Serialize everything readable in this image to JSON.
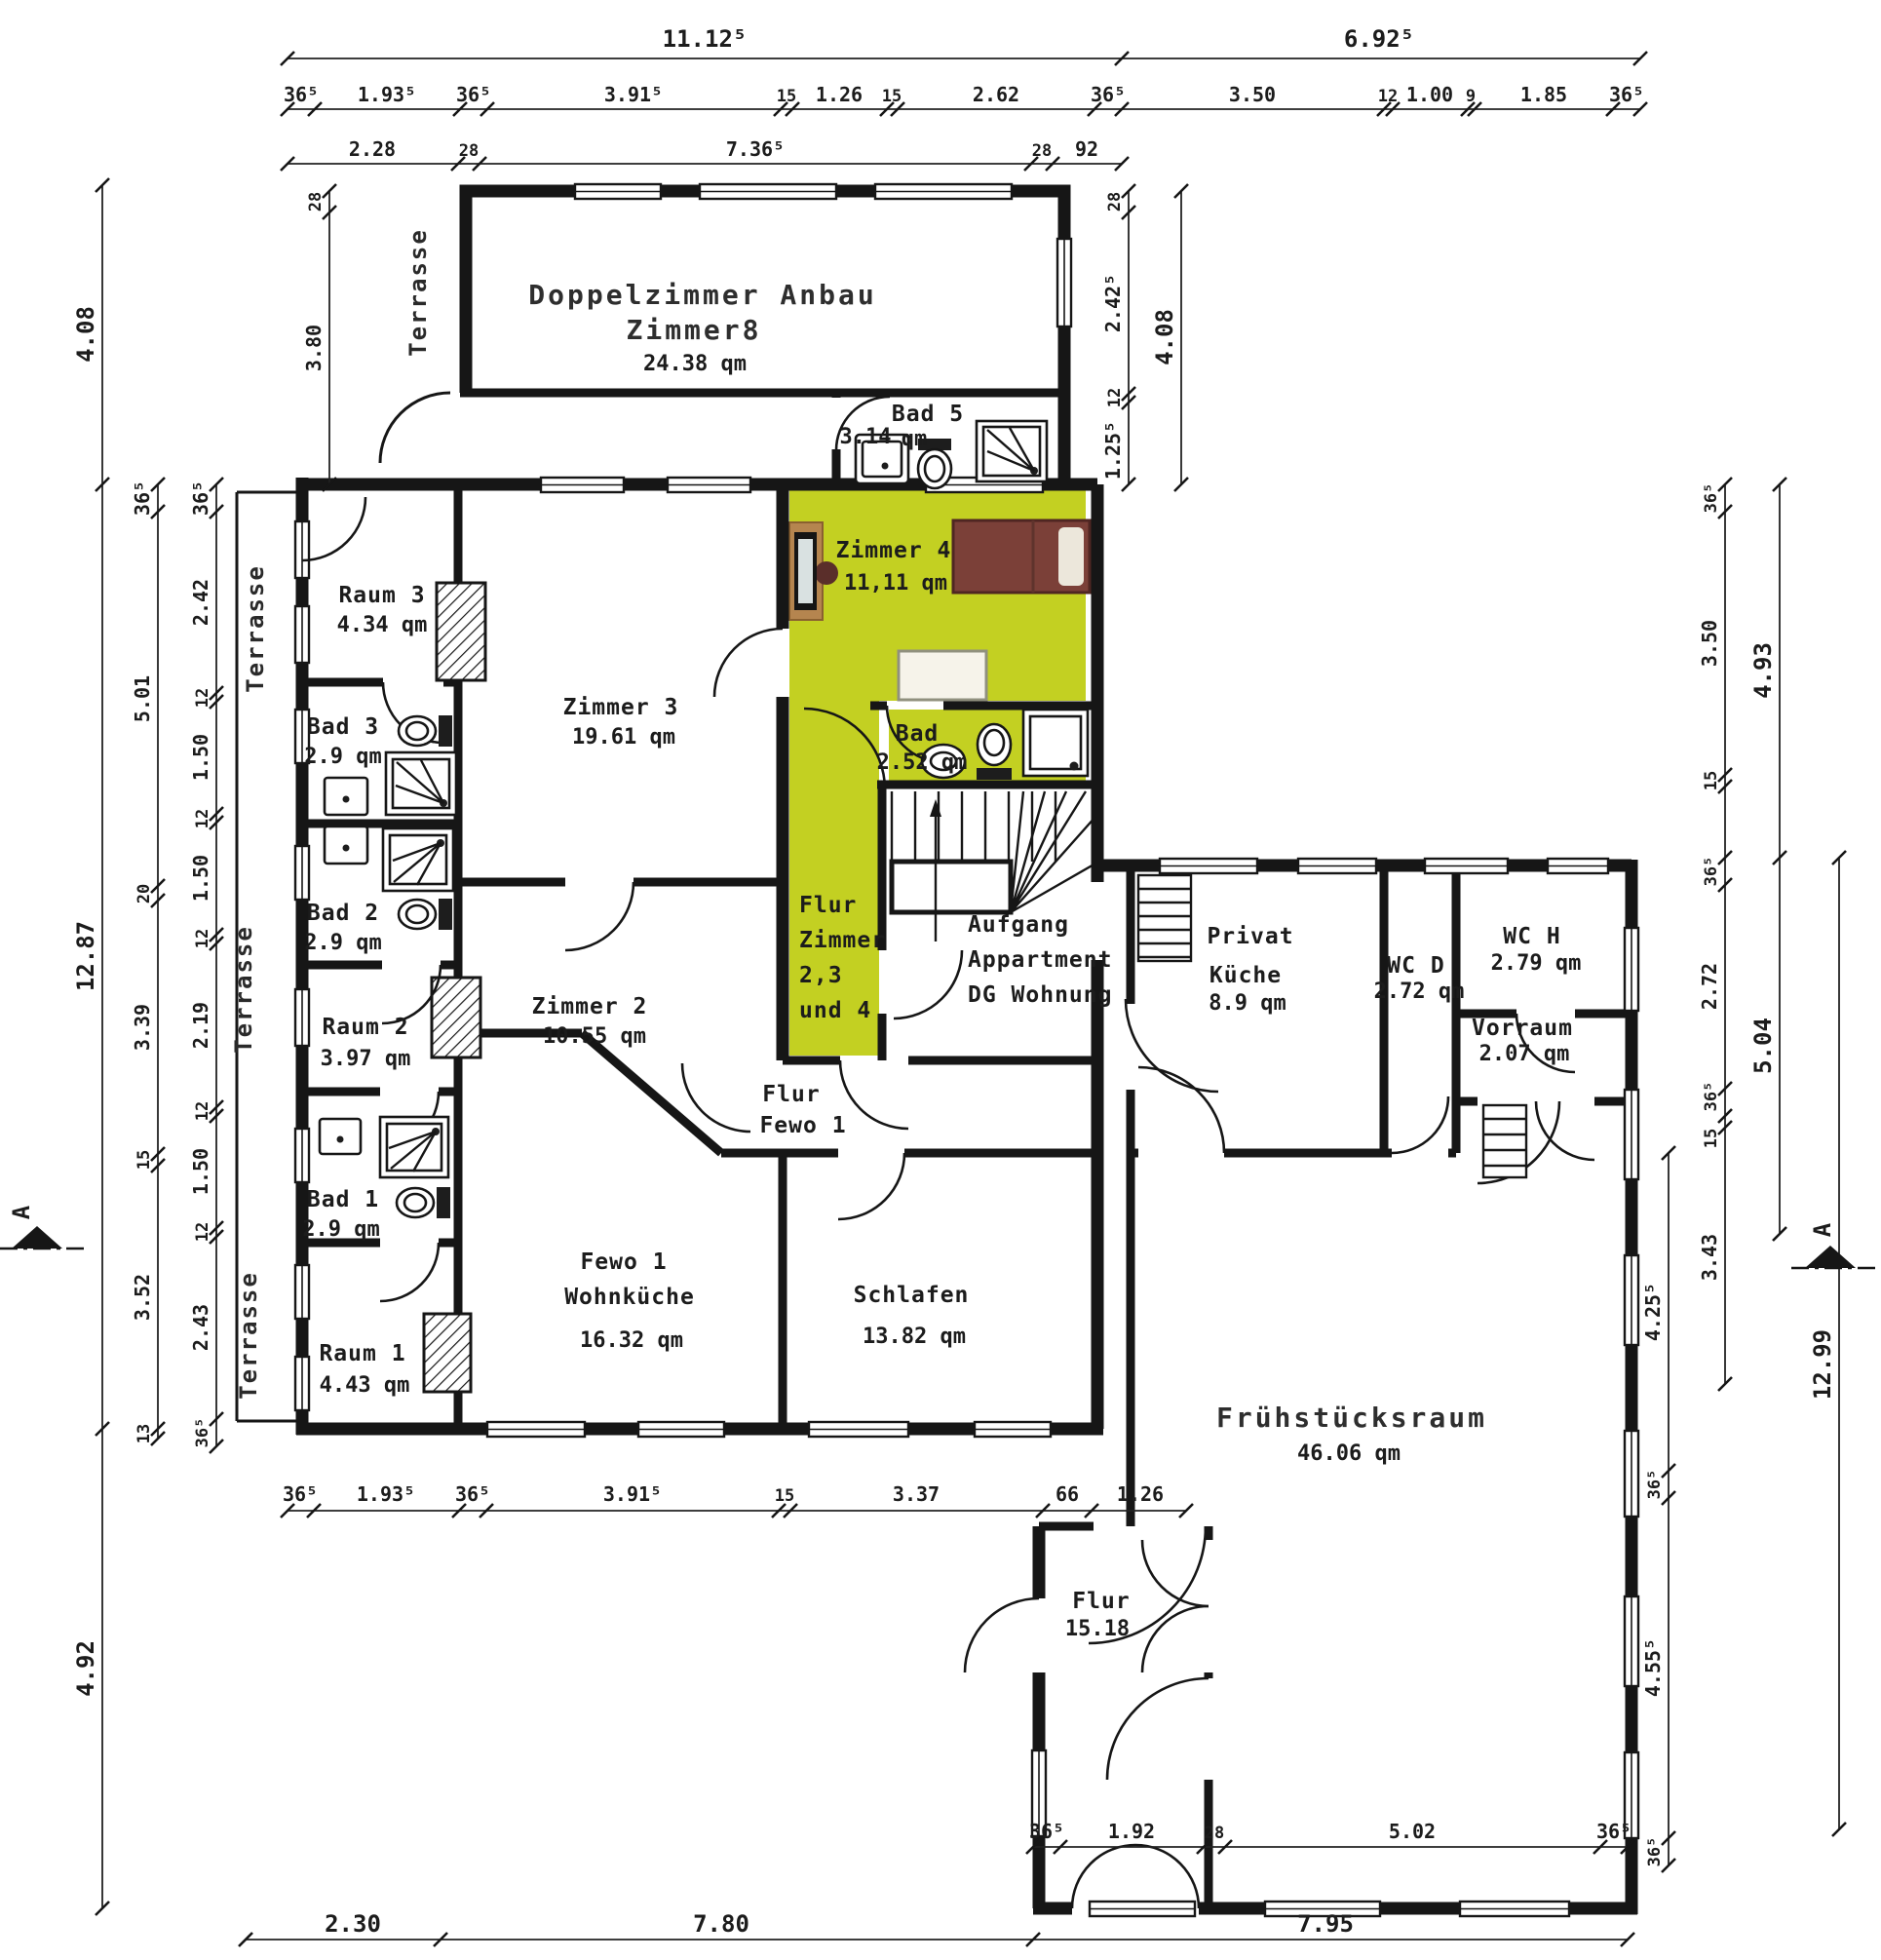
{
  "colors": {
    "highlight_green": "#c3d022",
    "bed_red": "#7b4038",
    "wall_black": "#161616",
    "wood_brown": "#b5854f"
  },
  "rooms": {
    "doppelzimmer": {
      "name": "Doppelzimmer Anbau",
      "name2": "Zimmer8",
      "area": "24.38 qm"
    },
    "bad5": {
      "name": "Bad 5",
      "area": "3.14",
      "unit": "qm"
    },
    "zimmer4": {
      "name": "Zimmer 4",
      "area": "11,11 qm"
    },
    "zimmer3": {
      "name": "Zimmer 3",
      "area": "19.61 qm"
    },
    "zimmer2": {
      "name": "Zimmer 2",
      "area": "10.55 qm"
    },
    "bad_og": {
      "name": "Bad",
      "area": "2.52 qm"
    },
    "flur_zimmer": {
      "line1": "Flur",
      "line2": "Zimmer",
      "line3": "2,3",
      "line4": "und 4"
    },
    "aufgang": {
      "line1": "Aufgang",
      "line2": "Appartment",
      "line3": "DG Wohnung"
    },
    "flur_fewo": {
      "line1": "Flur",
      "line2": "Fewo 1"
    },
    "fewo1": {
      "line1": "Fewo 1",
      "line2": "Wohnküche",
      "area": "16.32 qm"
    },
    "schlafen": {
      "name": "Schlafen",
      "area": "13.82 qm"
    },
    "raum3": {
      "name": "Raum 3",
      "area": "4.34 qm"
    },
    "bad3": {
      "name": "Bad 3",
      "area": "2.9 qm"
    },
    "bad2": {
      "name": "Bad 2",
      "area": "2.9 qm"
    },
    "raum2": {
      "name": "Raum 2",
      "area": "3.97 qm"
    },
    "bad1": {
      "name": "Bad 1",
      "area": "2.9 qm"
    },
    "raum1": {
      "name": "Raum 1",
      "area": "4.43 qm"
    },
    "privat": {
      "line1": "Privat",
      "line2": "Küche",
      "area": "8.9 qm"
    },
    "wcd": {
      "name": "WC D",
      "area": "2.72 qm"
    },
    "wch": {
      "name": "WC H",
      "area": "2.79 qm"
    },
    "vorraum": {
      "name": "Vorraum",
      "area": "2.07 qm"
    },
    "fruehstueck": {
      "name": "Frühstücksraum",
      "area": "46.06 qm"
    },
    "flur_eg": {
      "name": "Flur",
      "area": "15.18"
    }
  },
  "labels": {
    "terrasse": [
      "Terrasse",
      "Terrasse",
      "Terrasse",
      "Terrasse"
    ],
    "section": "A"
  },
  "dims": {
    "top1": [
      "11.12⁵",
      "6.92⁵"
    ],
    "top2": [
      "36⁵",
      "1.93⁵",
      "36⁵",
      "3.91⁵",
      "15",
      "1.26",
      "15",
      "2.62",
      "36⁵",
      "3.50",
      "12",
      "1.00",
      "9",
      "1.85",
      "36⁵"
    ],
    "top3": [
      "2.28",
      "28",
      "7.36⁵",
      "28",
      "92"
    ],
    "left_outer": [
      "4.08",
      "12.87",
      "4.92"
    ],
    "left_mid": [
      "36⁵",
      "5.01",
      "20",
      "3.39",
      "15",
      "3.52",
      "13"
    ],
    "left_inner": [
      "36⁵",
      "2.42",
      "12",
      "1.50",
      "12",
      "1.50",
      "12",
      "2.19",
      "12",
      "1.50",
      "12",
      "2.43",
      "36⁵"
    ],
    "anbau_left": [
      "28",
      "3.80"
    ],
    "anbau_right": [
      "28",
      "2.42⁵",
      "12",
      "1.25⁵"
    ],
    "anbau_right_outer": [
      "4.08"
    ],
    "right_wall": [
      "36⁵",
      "3.50",
      "15",
      "36⁵",
      "2.72",
      "36⁵",
      "15",
      "3.43"
    ],
    "right_inner2": [
      "4.25⁵",
      "36⁵",
      "4.55⁵",
      "36⁵"
    ],
    "right_mid": [
      "4.93",
      "5.04"
    ],
    "right_outer": [
      "12.99"
    ],
    "bottom_room": [
      "36⁵",
      "1.93⁵",
      "36⁵",
      "3.91⁵",
      "15",
      "3.37"
    ],
    "flur_top": [
      "66",
      "1.26"
    ],
    "bottom_right": [
      "36⁵",
      "1.92",
      "28",
      "5.02",
      "36⁵"
    ],
    "bottom_outer": [
      "2.30",
      "7.80",
      "7.95"
    ]
  }
}
